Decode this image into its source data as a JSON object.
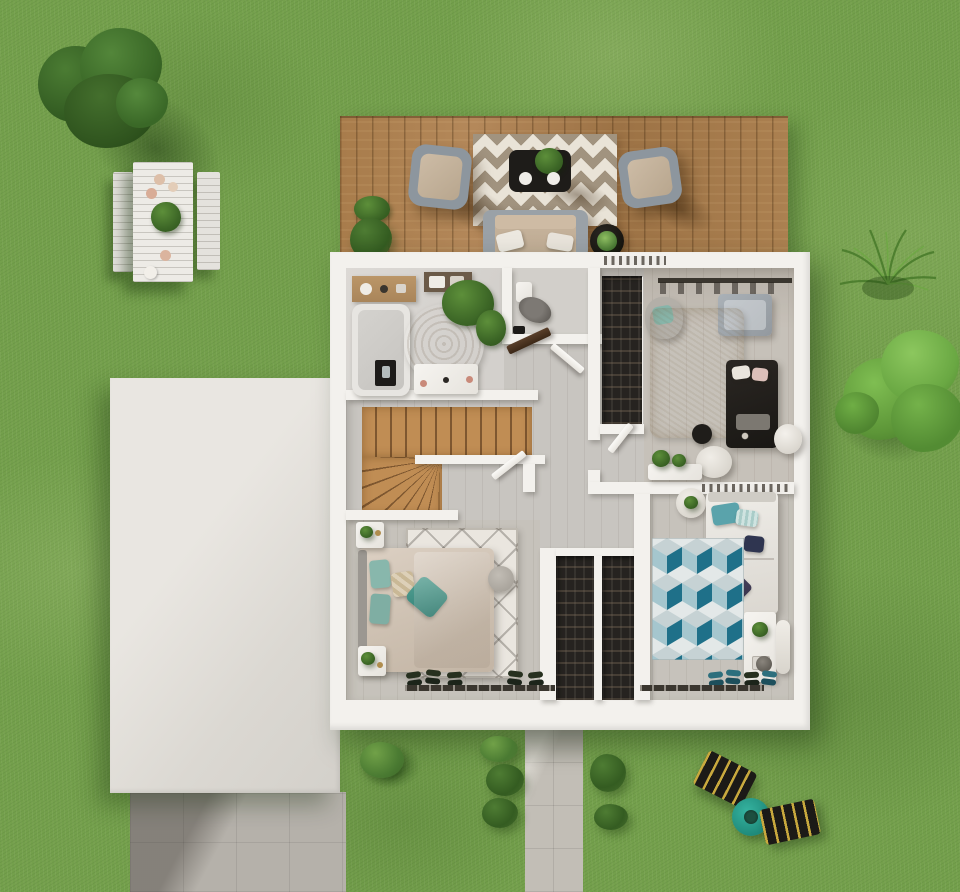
{
  "scene": {
    "description": "Photorealistic top-down 3D render of a house upper-floor plan set on a garden lawn, with wooden terrace, garage flat roof, tiled driveway, walkway and garden furniture",
    "view": "top-down bird's eye",
    "visible_text": "none"
  },
  "labels": {
    "lawn": "Garden lawn",
    "tree_northwest": "Large tree, north-west corner",
    "tree_east": "Tree, east side",
    "grass_tuft": "Ornamental grass tuft",
    "picnic_table": "Outdoor dining table with two benches",
    "terrace": "Wooden terrace deck",
    "terrace_rug": "Chevron outdoor rug",
    "coffee_table": "Black coffee table with plant and plates",
    "armchair_left": "Outdoor armchair, left",
    "armchair_right": "Outdoor armchair, right",
    "outdoor_sofa": "Outdoor sofa with white cushions",
    "side_table": "Round black side table with plant",
    "house": "Upper floor of the house",
    "bathroom": "Bathroom",
    "bathtub": "Bathtub with wooden shelf",
    "vanity": "Washbasin vanity",
    "wc": "Separate toilet room",
    "walkin_closet": "Open wardrobe shelving",
    "bedroom_one": "Bedroom 1, top right",
    "stairs": "Wooden winder staircase",
    "hallway": "Hallway landing",
    "master_bedroom": "Master bedroom",
    "wardrobes": "Built-in wardrobe columns",
    "bedroom_two": "Bedroom 2, bottom right",
    "garage_roof": "Garage flat roof",
    "driveway": "Tiled driveway",
    "walkway": "Garden walkway",
    "lounger_one": "Sun lounger, upper",
    "lounger_two": "Sun lounger, lower",
    "garden_table": "Round teal garden table"
  },
  "colors": {
    "grass": "#74a04c",
    "grass-light": "#8fb65d",
    "grass-dark": "#5b8a3a",
    "deck": "#ab8050",
    "deck-seam": "#6f4d26",
    "wall": "#f3f1ed",
    "garage": "#dfdcd7",
    "floor": "#c8c5c0",
    "floor-bath": "#dad7d3",
    "stairs": "#c08d54",
    "stairs-line": "#7e5730",
    "rug-terrace": "#e9e3d7",
    "rug-terrace-dark": "#a1937f",
    "closet-dark": "#262320",
    "teal": "#2aa18f",
    "lounger": "#1c1a17",
    "lounger-stripe": "#c9a93e",
    "driveway": "#b5b1aa",
    "walkway": "#c2beb6",
    "bed-master": "#d4c8bb",
    "pillow-teal": "#88b7ac",
    "bed-white": "#ebe9e4",
    "rug-cube-teal": "#1f7089",
    "rug-cube-blue": "#a5c6ce",
    "rug-cube-light": "#e3e8e8",
    "table-black": "#1e1c19",
    "chair-frame": "#8d969e",
    "plant-green": "#4a7a34"
  },
  "inventory": {
    "terrace": [
      "chevron rug",
      "black coffee table",
      "potted plant",
      "two plates",
      "armchair left",
      "armchair right",
      "sofa",
      "round side table",
      "two green plants"
    ],
    "bathroom": [
      "bathtub",
      "wooden shelf",
      "shower tray",
      "round jute rug",
      "plant",
      "towel shelf",
      "vanity with washbasin"
    ],
    "wc": [
      "wall-hung toilet",
      "brush"
    ],
    "bedroom_one": [
      "clothes rail",
      "armchair with teal cushion",
      "grey daybed",
      "shag rug",
      "black double bed",
      "black pouf",
      "white pouf",
      "round vase",
      "console with plants"
    ],
    "master_bedroom": [
      "double bed with teal pillows",
      "two nightstands with plants",
      "patterned rug",
      "grey pouf",
      "two wardrobe columns",
      "shoes",
      "sliding door track"
    ],
    "bedroom_two": [
      "single bed with teal and purple pillows",
      "cube-pattern rug",
      "desk with plant",
      "chair",
      "stool",
      "round table with plant",
      "shoes",
      "sliding door track"
    ],
    "garden": [
      "picnic table with benches",
      "two sun loungers",
      "teal garden table",
      "bushes",
      "trees",
      "clover patch"
    ]
  }
}
